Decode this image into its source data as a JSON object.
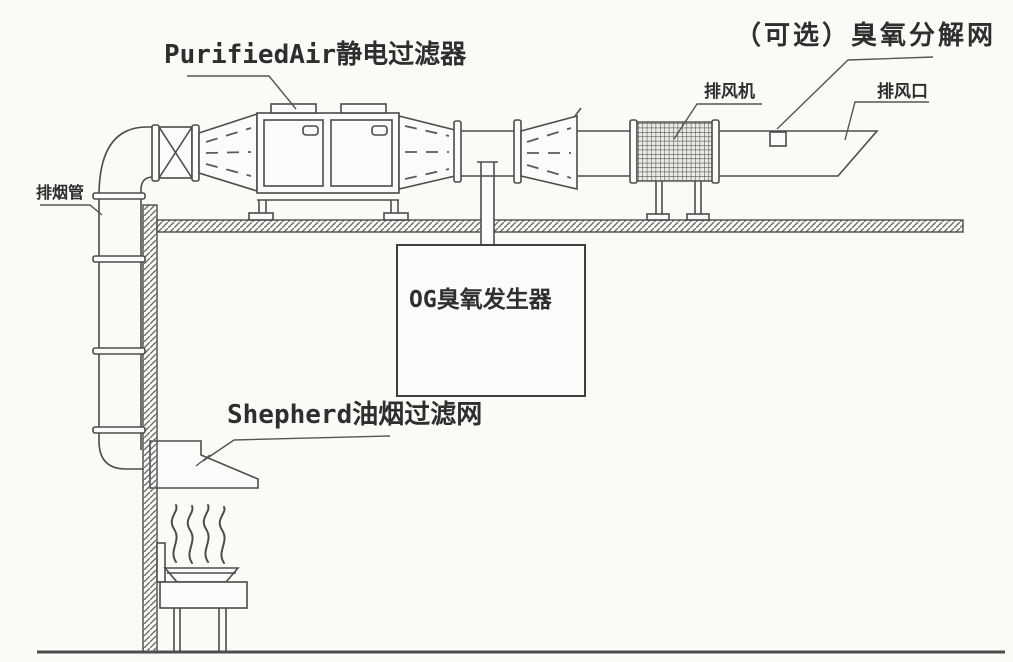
{
  "diagram": {
    "labels": {
      "electrostatic_filter": "PurifiedAir静电过滤器",
      "optional_ozone_net": "（可选）臭氧分解网",
      "exhaust_fan": "排风机",
      "exhaust_outlet": "排风口",
      "smoke_duct": "排烟管",
      "ozone_generator": "OG臭氧发生器",
      "grease_filter": "Shepherd油烟过滤网"
    },
    "colors": {
      "background": "#fbfaf7",
      "line": "#4c4c4c",
      "text": "#2e2e2e"
    }
  }
}
